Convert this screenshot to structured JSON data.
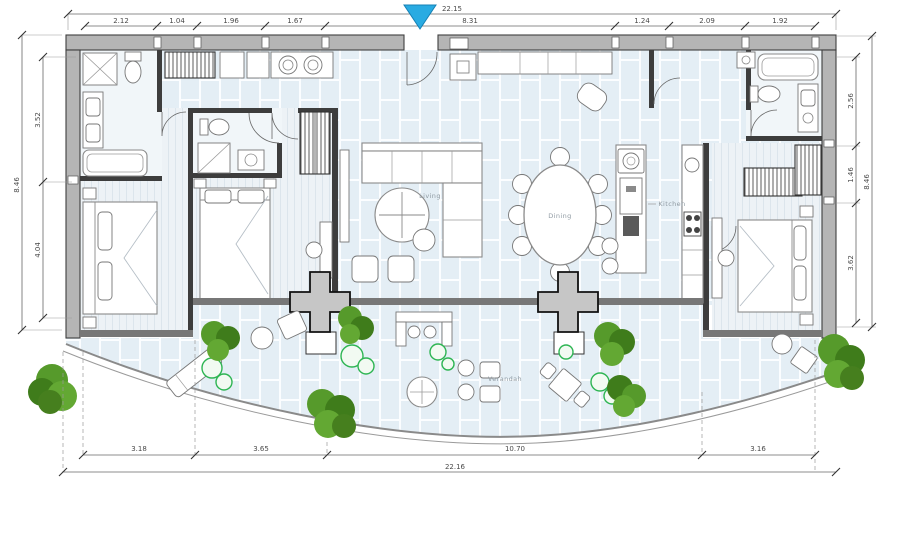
{
  "plan": {
    "type": "apartment-floor-plan",
    "rooms": {
      "living": "Living",
      "dining": "Dining",
      "kitchen": "Kitchen",
      "verandah": "Verandah"
    },
    "dims": {
      "top_overall": "22.15",
      "top_chain": [
        "2.12",
        "1.04",
        "1.96",
        "1.67",
        "8.31",
        "1.24",
        "2.09",
        "1.92"
      ],
      "left_overall": "8.46",
      "left_chain": [
        "3.52",
        "4.04"
      ],
      "right_chain": [
        "2.56",
        "1.46",
        "3.62"
      ],
      "right_overall": "8.46",
      "bottom_chain": [
        "3.18",
        "3.65",
        "10.70",
        "3.16"
      ],
      "bottom_overall": "22.16"
    },
    "marker": {
      "name": "entrance-marker",
      "color": "#29abe2"
    },
    "colors": {
      "wall": "#b5b5b5",
      "wall_outline": "#3f3f3f",
      "interior_wall": "#3d3d3d",
      "tile_floor": "#e4eef5",
      "wood_floor": "#edf2f6",
      "glass_door_band": "#777777",
      "dimension_text": "#4a4a4a",
      "tree_green": "#569a2b",
      "tree_green_dark": "#3f7c1b",
      "shrub_outline": "#2eb553",
      "entrance_marker": "#29abe2"
    }
  }
}
